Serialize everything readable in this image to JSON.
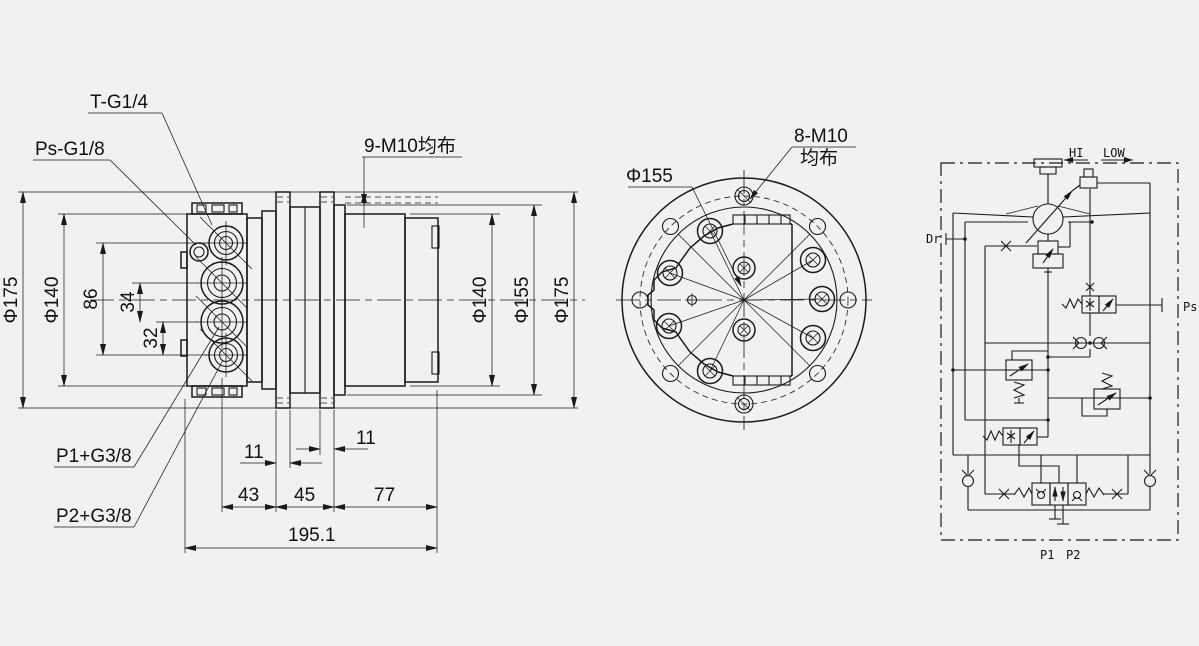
{
  "colors": {
    "background": "#f1f2f0",
    "line": "#1a1a1a"
  },
  "side_view": {
    "port_labels": {
      "t": "T-G1/4",
      "ps": "Ps-G1/8",
      "p1": "P1+G3/8",
      "p2": "P2+G3/8"
    },
    "bolt_note": "9-M10均布",
    "dims": {
      "dia175_left": "Φ175",
      "dia140_left": "Φ140",
      "d86": "86",
      "d34": "34",
      "d32": "32",
      "d11_left": "11",
      "d11_right": "11",
      "d43": "43",
      "d45": "45",
      "d77": "77",
      "total": "195.1",
      "dia140_right": "Φ140",
      "dia155_right": "Φ155",
      "dia175_right": "Φ175"
    }
  },
  "front_view": {
    "dia155": "Φ155",
    "bolt_note_line1": "8-M10",
    "bolt_note_line2": "均布"
  },
  "schematic": {
    "hi": "HI",
    "low": "LOW",
    "dr": "Dr",
    "ps": "Ps",
    "p1": "P1",
    "p2": "P2"
  }
}
